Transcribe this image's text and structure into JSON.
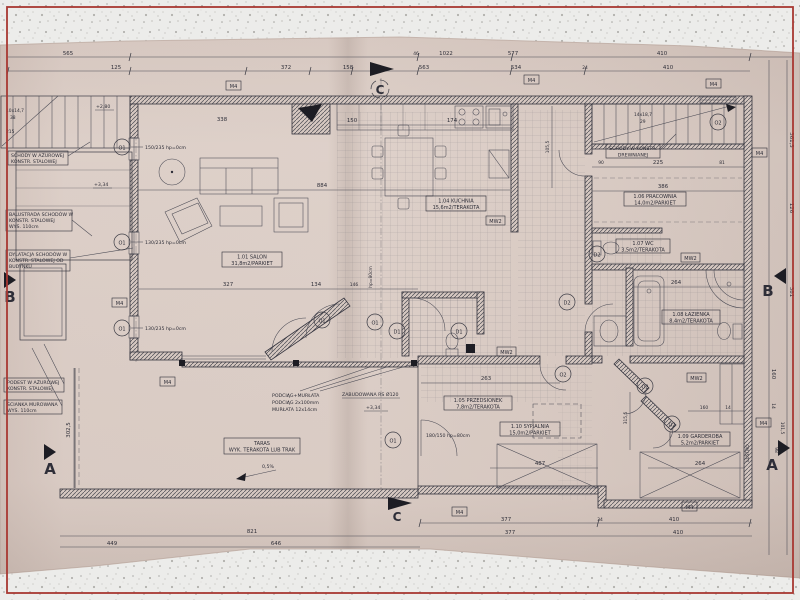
{
  "colors": {
    "frame": "#a83832",
    "paper": "#e0d3cc",
    "ink": "#34343e",
    "speckle_bg": "#ececea"
  },
  "rooms": [
    {
      "l1": "1.01 SALON",
      "l2": "31,8m2/PARKIET"
    },
    {
      "l1": "1.04 KUCHNIA",
      "l2": "15,6m2/TERAKOTA"
    },
    {
      "l1": "1.05 PRZEDSIONEK",
      "l2": "7,8m2/TERAKOTA"
    },
    {
      "l1": "1.06 PRACOWNIA",
      "l2": "14,0m2/PARKIET"
    },
    {
      "l1": "1.07 WC",
      "l2": "3,5m2/TERAKOTA"
    },
    {
      "l1": "1.08 ŁAZIENKA",
      "l2": "8,4m2/TERAKOTA"
    },
    {
      "l1": "1.09 GARDEROBA",
      "l2": "5,2m2/PARKIET"
    },
    {
      "l1": "1.10 SYPIALNIA",
      "l2": "15,0m2/PARKIET"
    },
    {
      "l1": "TARAS",
      "l2": "WYK. TERAKOTA LUB TRAK"
    }
  ],
  "ann": {
    "schody_azur1": "SCHODY W AŻUROWEJ",
    "schody_azur2": "KONSTR. STALOWEJ",
    "balustrada1": "BALUSTRADA SCHODÓW W",
    "balustrada2": "KONSTR. STALOWEJ",
    "balustrada3": "WYS. 110cm",
    "dylatacja1": "DYLATACJA SCHODÓW W",
    "dylatacja2": "KONSTR. STALOWEJ OD",
    "dylatacja3": "BUDYNKU",
    "podest1": "PODEST W AŻUROWEJ",
    "podest2": "KONSTR. STALOWEJ",
    "scianka1": "ŚCIANKA MUROWANA",
    "scianka2": "WYS. 110cm",
    "schody_drewn1": "SCHODY W KONSTR.",
    "schody_drewn2": "DREWNIANEJ",
    "podciag1": "PODCIĄG+MURŁATA",
    "podciag2": "PODCIĄG 2x100mm",
    "podciag3": "MURŁATA 12x14cm",
    "zabudowana": "ZABUDOWANA RS Ø120",
    "lustro": "LUSTRO",
    "slope": "0,5%",
    "lvl280": "+2,80",
    "lvl334": "+3,34",
    "stairs_left1": "10x14,7",
    "stairs_left2": "38",
    "stairs_left3": "215",
    "stairs_right1": "14x18,7",
    "stairs_right2": "29",
    "hp80v": "hp=80cm"
  },
  "win": {
    "w150": "150/235 hp=0cm",
    "w130": "130/235 hp=0cm",
    "w180": "180/150 hp=80cm"
  },
  "mk": {
    "a": "A",
    "b": "B",
    "c": "C",
    "m4": "M4",
    "mw2": "MW2",
    "o1": "O1",
    "o2": "O2",
    "d1": "D1",
    "d2": "D2"
  },
  "dims": {
    "top": [
      "565",
      "1022",
      "46",
      "577",
      "410",
      "125",
      "372",
      "158",
      "563",
      "534",
      "24"
    ],
    "bottom": [
      "377",
      "410",
      "34",
      "821",
      "646",
      "449"
    ],
    "left": [
      "302,5"
    ],
    "right": [
      "361,5",
      "126",
      "381",
      "160",
      "14",
      "101,5",
      "98"
    ],
    "inner": [
      "884",
      "338",
      "174",
      "150",
      "105,5",
      "225",
      "81",
      "90",
      "386",
      "327",
      "134",
      "146",
      "263",
      "487",
      "264",
      "315,5",
      "160",
      "14"
    ]
  }
}
